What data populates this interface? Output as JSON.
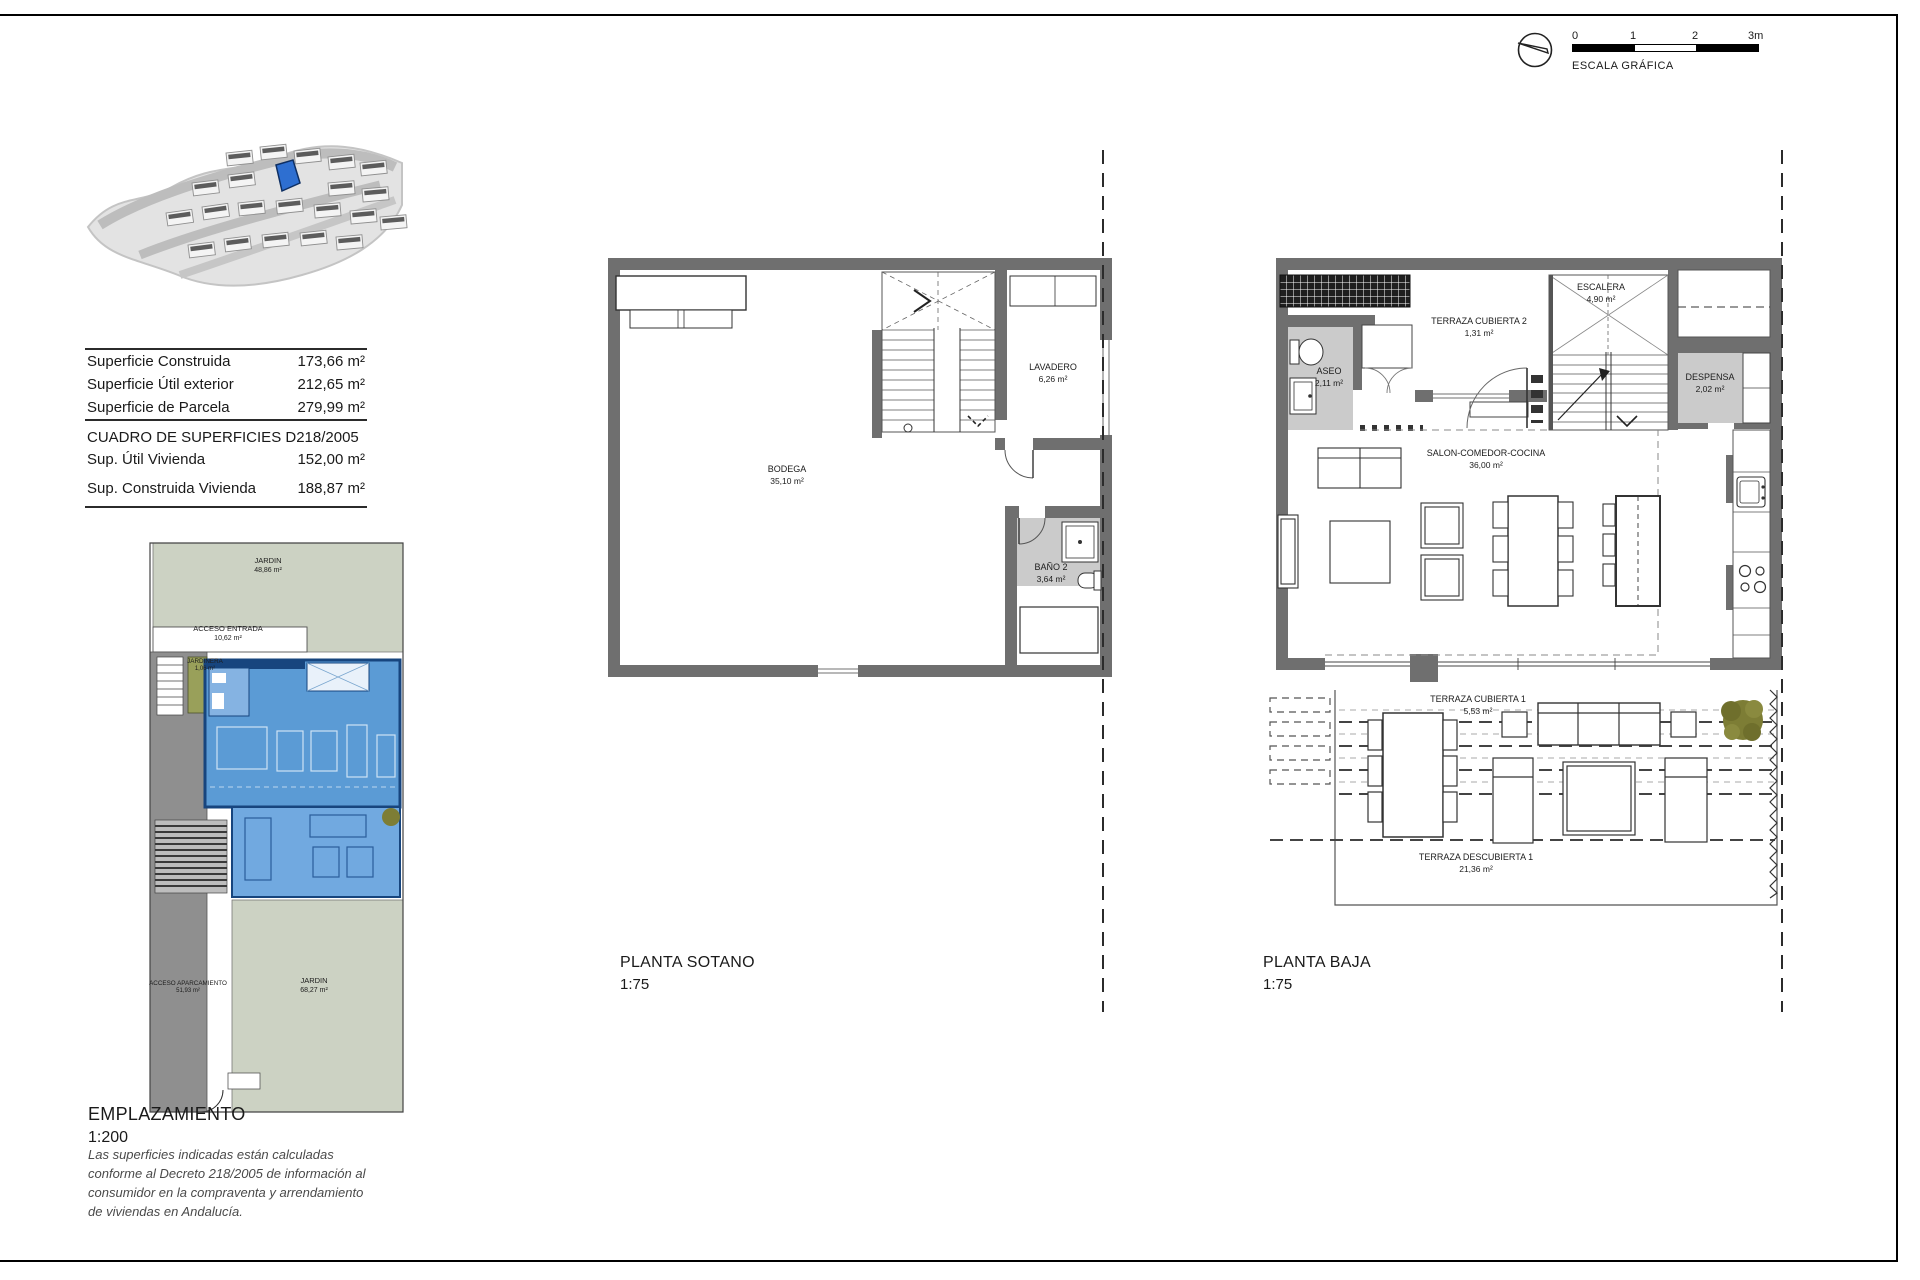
{
  "colors": {
    "wall": "#6f6f6f",
    "room_floor": "#cbcbcb",
    "garden_green": "#ccd2c3",
    "driveway_gray": "#8f8f8f",
    "planter_olive": "#99a05a",
    "highlight_blue": "#5b9bd5",
    "highlight_blue_dark": "#17457e",
    "tree_olive": "#7d7d35"
  },
  "scale_graphic": {
    "label": "ESCALA GRÁFICA",
    "ticks": [
      "0",
      "1",
      "2",
      "3m"
    ]
  },
  "surfaces_table": {
    "rows": [
      {
        "label": "Superficie Construida",
        "value": "173,66 m²"
      },
      {
        "label": "Superficie Útil exterior",
        "value": "212,65 m²"
      },
      {
        "label": "Superficie de Parcela",
        "value": "279,99 m²"
      }
    ],
    "decree_header": "CUADRO DE SUPERFICIES D218/2005",
    "decree_rows": [
      {
        "label": "Sup. Útil Vivienda",
        "value": "152,00 m²"
      },
      {
        "label": "Sup. Construida Vivienda",
        "value": "188,87 m²"
      }
    ]
  },
  "sotano": {
    "title": "PLANTA SOTANO",
    "scale": "1:75",
    "rooms": {
      "bodega": {
        "name": "BODEGA",
        "area": "35,10 m²"
      },
      "lavadero": {
        "name": "LAVADERO",
        "area": "6,26 m²"
      },
      "bano2": {
        "name": "BAÑO 2",
        "area": "3,64 m²"
      }
    }
  },
  "baja": {
    "title": "PLANTA BAJA",
    "scale": "1:75",
    "rooms": {
      "aseo": {
        "name": "ASEO",
        "area": "2,11 m²"
      },
      "terraza_cubierta2": {
        "name": "TERRAZA CUBIERTA 2",
        "area": "1,31 m²"
      },
      "escalera": {
        "name": "ESCALERA",
        "area": "4,90 m²"
      },
      "despensa": {
        "name": "DESPENSA",
        "area": "2,02 m²"
      },
      "salon": {
        "name": "SALON-COMEDOR-COCINA",
        "area": "36,00 m²"
      },
      "terraza_cubierta1": {
        "name": "TERRAZA CUBIERTA 1",
        "area": "5,53 m²"
      },
      "terraza_descubierta1": {
        "name": "TERRAZA DESCUBIERTA 1",
        "area": "21,36 m²"
      }
    }
  },
  "emplazamiento": {
    "title": "EMPLAZAMIENTO",
    "scale": "1:200",
    "disclaimer": "Las superficies indicadas están calculadas conforme al Decreto 218/2005 de información al consumidor en la compraventa y arrendamiento de viviendas en Andalucía.",
    "areas": {
      "jardin_top": {
        "name": "JARDIN",
        "area": "48,86 m²"
      },
      "acceso_entrada": {
        "name": "ACCESO ENTRADA",
        "area": "10,62 m²"
      },
      "jardinera": {
        "name": "JARDINERA",
        "area": "1,06 m²"
      },
      "acceso_aparcamiento": {
        "name": "ACCESO APARCAMIENTO",
        "area": "51,93 m²"
      },
      "jardin_bottom": {
        "name": "JARDIN",
        "area": "68,27 m²"
      }
    }
  }
}
